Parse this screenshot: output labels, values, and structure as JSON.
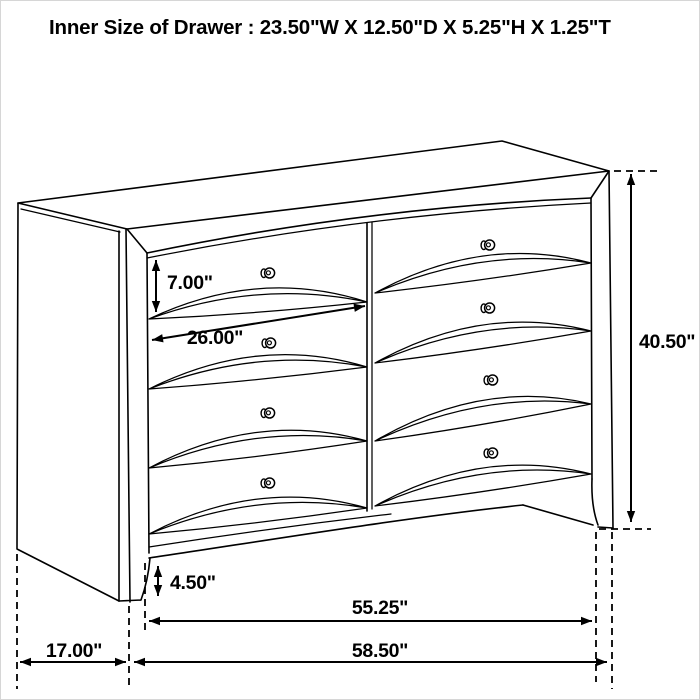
{
  "title": "Inner Size of Drawer : 23.50\"W X 12.50\"D X 5.25\"H X 1.25\"T",
  "dimensions": {
    "drawer_face_height": "7.00\"",
    "drawer_face_width": "26.00\"",
    "overall_height": "40.50\"",
    "base_height": "4.50\"",
    "front_width": "55.25\"",
    "overall_width": "58.50\"",
    "side_depth": "17.00\""
  },
  "colors": {
    "ink": "#000000",
    "background": "#ffffff"
  }
}
